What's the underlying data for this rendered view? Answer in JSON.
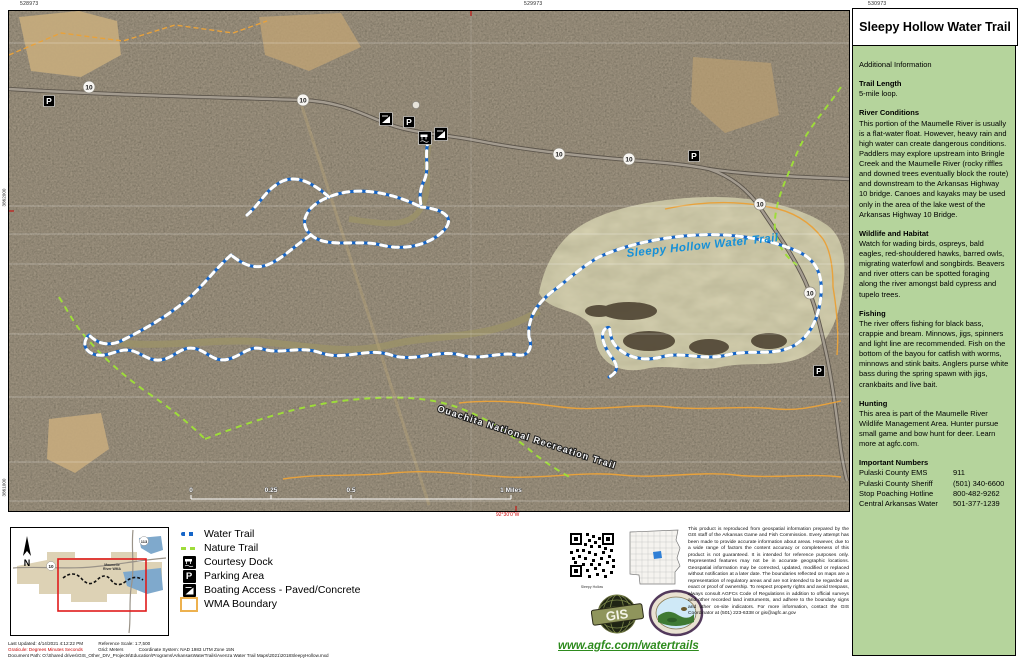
{
  "page_title": "Sleepy Hollow Water Trail",
  "map": {
    "shield": "10",
    "parking_letter": "P",
    "label_water_trail": "Sleepy Hollow Water Trail",
    "label_ouachita": "Ouachita National Recreation Trail",
    "grid_top": [
      "528973",
      "529973",
      "530973"
    ],
    "grid_left": [
      "3862000",
      "3861000"
    ],
    "graticule_bottom": "92°30'0\"W",
    "scale": [
      "0",
      "0.25",
      "0.5",
      "1 Miles"
    ]
  },
  "legend": {
    "items": [
      {
        "label": "Water Trail"
      },
      {
        "label": "Nature Trail"
      },
      {
        "label": "Courtesy Dock"
      },
      {
        "label": "Parking Area"
      },
      {
        "label": "Boating Access - Paved/Concrete"
      },
      {
        "label": "WMA Boundary"
      }
    ]
  },
  "inset": {
    "north": "N",
    "shield_a": "10",
    "shield_b": "113",
    "wma_line1": "Maumelle",
    "wma_line2": "River WMA"
  },
  "metadata": {
    "updated": "Last Updated: 4/14/2021 4:12:22 PM",
    "ref_scale": "Reference Scale: 1:7,500",
    "graticule": "Graticule: Degrees Minutes Seconds",
    "grid": "Grid: Meters",
    "coord_system": "Coordinate System: NAD 1983 UTM Zone 15N",
    "doc_path": "Document Path: O:\\Shared drives\\GIS_Other_DIV_Projects\\Education\\Programs\\ArkansasWaterTrails\\Avenza Water Trail Maps\\2021\\2018SleepyHollow.mxd"
  },
  "qr": {
    "caption": "Sleepy Hollow"
  },
  "logos": {
    "gis": "GIS"
  },
  "links": {
    "watertrails": "www.agfc.com/watertrails"
  },
  "disclaimer": "This product is reproduced from geospatial information prepared by the GIS staff of the Arkansas Game and Fish Commission. Every attempt has been made to provide accurate information about areas. However, due to a wide range of factors the content accuracy or completeness of this product is not guaranteed. It is intended for reference purposes only. Represented features may not be in accurate geographic locations. Geospatial information may be corrected, updated, modified or replaced without notification at a later date. The boundaries reflected on maps are a representation of regulatory areas and are not intended to be regarded as exact or proof of ownership. To respect property rights and avoid trespass, always consult AGFCs Code of Regulations in addition to official surveys and other recorded land instruments, and adhere to the boundary signs and other on-site indicators. For more information, contact the GIS Coordinator at (501) 223-6338 or gis@agfc.ar.gov",
  "sidebar": {
    "title": "Sleepy Hollow Water Trail",
    "subtitle": "Additional Information",
    "sections": [
      {
        "heading": "Trail Length",
        "body": "5-mile loop."
      },
      {
        "heading": "River Conditions",
        "body": "This portion of the Maumelle River is usually is a flat-water float. However, heavy rain and high water can create dangerous conditions.  Paddlers may explore upstream into Bringle Creek and the Maumelle River (rocky riffles and downed trees eventually block the route) and downstream to the Arkansas Highway 10 bridge. Canoes and kayaks may be used only in the area of the lake west of the Arkansas Highway 10 Bridge."
      },
      {
        "heading": "Wildlife and Habitat",
        "body": "Watch for wading birds, ospreys, bald eagles, red-shouldered hawks, barred owls, migrating waterfowl and songbirds. Beavers and river otters can be spotted foraging along the river amongst bald cypress and tupelo trees."
      },
      {
        "heading": "Fishing",
        "body": "The river offers fishing for black bass, crappie and bream. Minnows, jigs, spinners and light line are recommended. Fish on the bottom of the bayou for catfish with worms, minnows and stink baits. Anglers purse white bass during the spring spawn with jigs, crankbaits and live bait."
      },
      {
        "heading": "Hunting",
        "body": "This area is part of the Maumelle River Wildlife Management Area. Hunter pursue small game and bow hunt for deer. Learn more at agfc.com."
      }
    ],
    "important": {
      "heading": "Important Numbers",
      "rows": [
        {
          "name": "Pulaski County EMS",
          "value": "911"
        },
        {
          "name": "Pulaski County Sheriff",
          "value": "(501) 340-6600"
        },
        {
          "name": "Stop Poaching Hotline",
          "value": "800-482-9262"
        },
        {
          "name": "Central Arkansas Water",
          "value": "501-377-1239"
        }
      ]
    }
  },
  "colors": {
    "water_trail": "#1565c8",
    "nature_trail": "#9edc3a",
    "wma_boundary": "#e8a23c",
    "panel_green": "#b5d49c",
    "link_green": "#2e8b1e",
    "trail_label_blue": "#1590d8"
  }
}
